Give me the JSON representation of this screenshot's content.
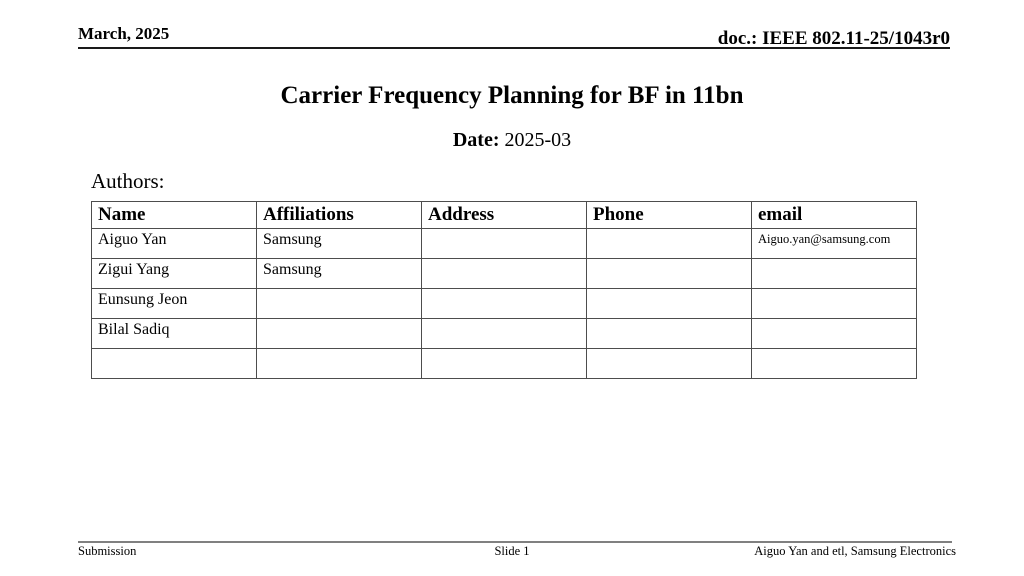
{
  "slide": {
    "header": {
      "left": "March, 2025",
      "right": "doc.: IEEE 802.11-25/1043r0"
    },
    "title": "Carrier Frequency Planning for BF in 11bn",
    "date": {
      "label": "Date:",
      "value": "2025-03"
    },
    "authors_label": "Authors:",
    "table": {
      "headers": [
        "Name",
        "Affiliations",
        "Address",
        "Phone",
        "email"
      ],
      "rows": [
        {
          "name": "Aiguo Yan",
          "affiliations": "Samsung",
          "address": "",
          "phone": "",
          "email": "Aiguo.yan@samsung.com"
        },
        {
          "name": "Zigui Yang",
          "affiliations": "Samsung",
          "address": "",
          "phone": "",
          "email": ""
        },
        {
          "name": "Eunsung Jeon",
          "affiliations": "",
          "address": "",
          "phone": "",
          "email": ""
        },
        {
          "name": "Bilal Sadiq",
          "affiliations": "",
          "address": "",
          "phone": "",
          "email": ""
        },
        {
          "name": "",
          "affiliations": "",
          "address": "",
          "phone": "",
          "email": ""
        }
      ]
    },
    "footer": {
      "left": "Submission",
      "center": "Slide 1",
      "right": "Aiguo Yan and etl, Samsung Electronics"
    },
    "colors": {
      "text": "#000000",
      "header_rule": "#1a1a1a",
      "table_border": "#4d4d4d",
      "footer_rule": "#808080",
      "background": "#ffffff"
    }
  }
}
